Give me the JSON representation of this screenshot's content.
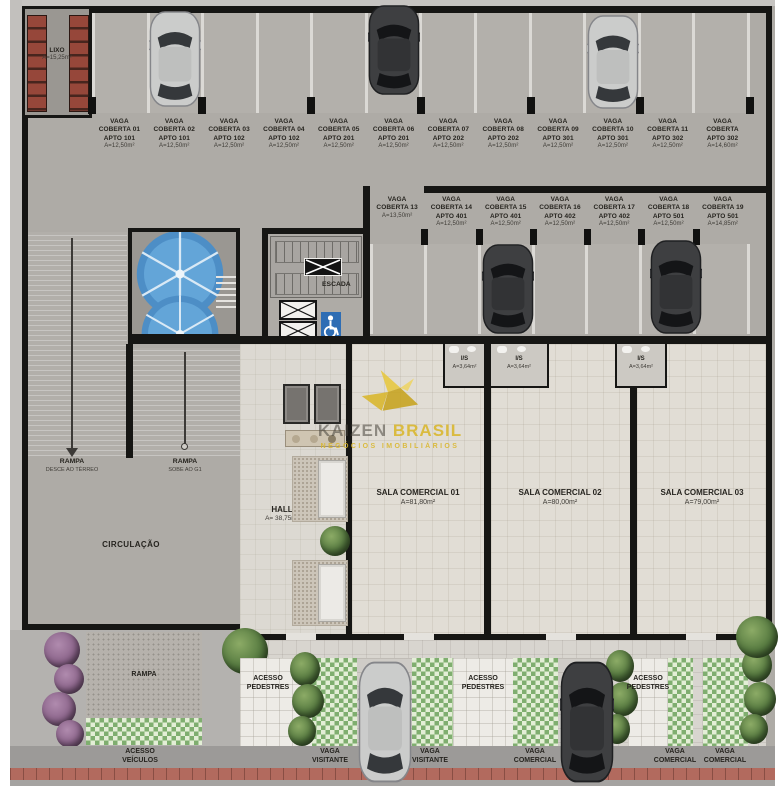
{
  "watermark": {
    "brand_left": "KAIZEN",
    "brand_right": "BRASIL",
    "tagline": "NEGÓCIOS IMOBILIÁRIOS"
  },
  "labels": {
    "lixo_name": "LIXO",
    "lixo_area": "A=15,25m²",
    "escada": "ESCADA",
    "hall_name": "HALL",
    "hall_area": "A= 38,75m²",
    "circulacao": "CIRCULAÇÃO",
    "rampa1_name": "RAMPA",
    "rampa1_sub": "DESCE AO TÉRREO",
    "rampa2_name": "RAMPA",
    "rampa2_sub": "SOBE AO G1",
    "rampa3_name": "RAMPA",
    "is_name": "I/S",
    "is_area": "A=3,64m²",
    "acesso_veiculos_1": "ACESSO",
    "acesso_veiculos_2": "VEÍCULOS",
    "acesso_pedestres_1": "ACESSO",
    "acesso_pedestres_2": "PEDESTRES",
    "vaga_visitante_1": "VAGA",
    "vaga_visitante_2": "VISITANTE",
    "vaga_comercial_1": "VAGA",
    "vaga_comercial_2": "COMERCIAL"
  },
  "row1": [
    {
      "l1": "VAGA",
      "l2": "COBERTA 01",
      "l3": "APTO 101",
      "l4": "A=12,50m²"
    },
    {
      "l1": "VAGA",
      "l2": "COBERTA 02",
      "l3": "APTO 101",
      "l4": "A=12,50m²"
    },
    {
      "l1": "VAGA",
      "l2": "COBERTA 03",
      "l3": "APTO 102",
      "l4": "A=12,50m²"
    },
    {
      "l1": "VAGA",
      "l2": "COBERTA 04",
      "l3": "APTO 102",
      "l4": "A=12,50m²"
    },
    {
      "l1": "VAGA",
      "l2": "COBERTA 05",
      "l3": "APTO 201",
      "l4": "A=12,50m²"
    },
    {
      "l1": "VAGA",
      "l2": "COBERTA 06",
      "l3": "APTO 201",
      "l4": "A=12,50m²"
    },
    {
      "l1": "VAGA",
      "l2": "COBERTA 07",
      "l3": "APTO 202",
      "l4": "A=12,50m²"
    },
    {
      "l1": "VAGA",
      "l2": "COBERTA 08",
      "l3": "APTO 202",
      "l4": "A=12,50m²"
    },
    {
      "l1": "VAGA",
      "l2": "COBERTA 09",
      "l3": "APTO 301",
      "l4": "A=12,50m²"
    },
    {
      "l1": "VAGA",
      "l2": "COBERTA 10",
      "l3": "APTO 301",
      "l4": "A=12,50m²"
    },
    {
      "l1": "VAGA",
      "l2": "COBERTA 11",
      "l3": "APTO 302",
      "l4": "A=12,50m²"
    },
    {
      "l1": "VAGA",
      "l2": "COBERTA",
      "l3": "APTO 302",
      "l4": "A=14,60m²"
    }
  ],
  "row2": [
    {
      "l1": "VAGA",
      "l2": "COBERTA 13",
      "l3": "",
      "l4": "A=13,50m²"
    },
    {
      "l1": "VAGA",
      "l2": "COBERTA 14",
      "l3": "APTO 401",
      "l4": "A=12,50m²"
    },
    {
      "l1": "VAGA",
      "l2": "COBERTA 15",
      "l3": "APTO 401",
      "l4": "A=12,50m²"
    },
    {
      "l1": "VAGA",
      "l2": "COBERTA 16",
      "l3": "APTO 402",
      "l4": "A=12,50m²"
    },
    {
      "l1": "VAGA",
      "l2": "COBERTA 17",
      "l3": "APTO 402",
      "l4": "A=12,50m²"
    },
    {
      "l1": "VAGA",
      "l2": "COBERTA 18",
      "l3": "APTO 501",
      "l4": "A=12,50m²"
    },
    {
      "l1": "VAGA",
      "l2": "COBERTA 19",
      "l3": "APTO 501",
      "l4": "A=14,85m²"
    }
  ],
  "salas": [
    {
      "name": "SALA COMERCIAL 01",
      "area": "A=81,80m²"
    },
    {
      "name": "SALA COMERCIAL 02",
      "area": "A=80,00m²"
    },
    {
      "name": "SALA COMERCIAL 03",
      "area": "A=79,00m²"
    }
  ],
  "colors": {
    "tank_blue": "#5f9fd3",
    "bin_red": "#96473a",
    "grass_green": "#7fae6f",
    "brick_red": "#b26a5e",
    "watermark_yellow": "#d9b62a",
    "accessibility_blue": "#2e6db4"
  }
}
